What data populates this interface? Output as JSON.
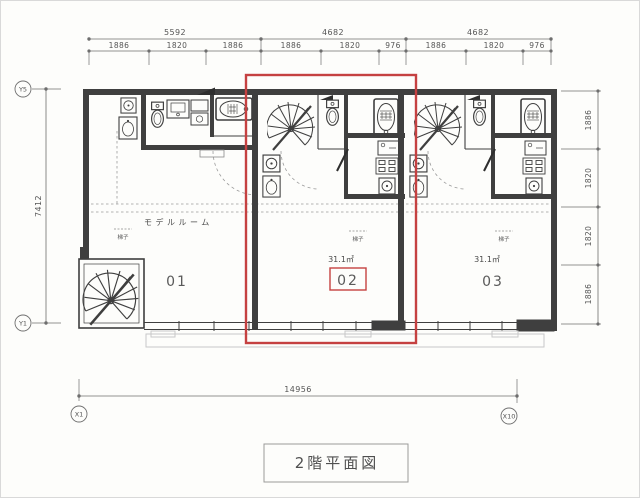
{
  "drawing": {
    "title": "2階平面図",
    "grid": {
      "y5": "Y5",
      "y1": "Y1",
      "x1": "X1",
      "x10": "X10"
    },
    "dims": {
      "top_major": [
        "5592",
        "4682",
        "4682"
      ],
      "top_minor": [
        "1886",
        "1820",
        "1886",
        "1886",
        "1820",
        "976",
        "1886",
        "1820",
        "976"
      ],
      "left": "7412",
      "right": [
        "1886",
        "1820",
        "1820",
        "1886"
      ],
      "bottom": "14956"
    },
    "units": [
      {
        "number": "01",
        "label": "モデルルーム",
        "note": "梯子"
      },
      {
        "number": "02",
        "area": "31.1㎡",
        "note": "梯子"
      },
      {
        "number": "03",
        "area": "31.1㎡",
        "note": "梯子"
      }
    ],
    "colors": {
      "highlight": "#c54141",
      "wall": "#3f3f3f",
      "dim": "#6e6e6e"
    }
  }
}
